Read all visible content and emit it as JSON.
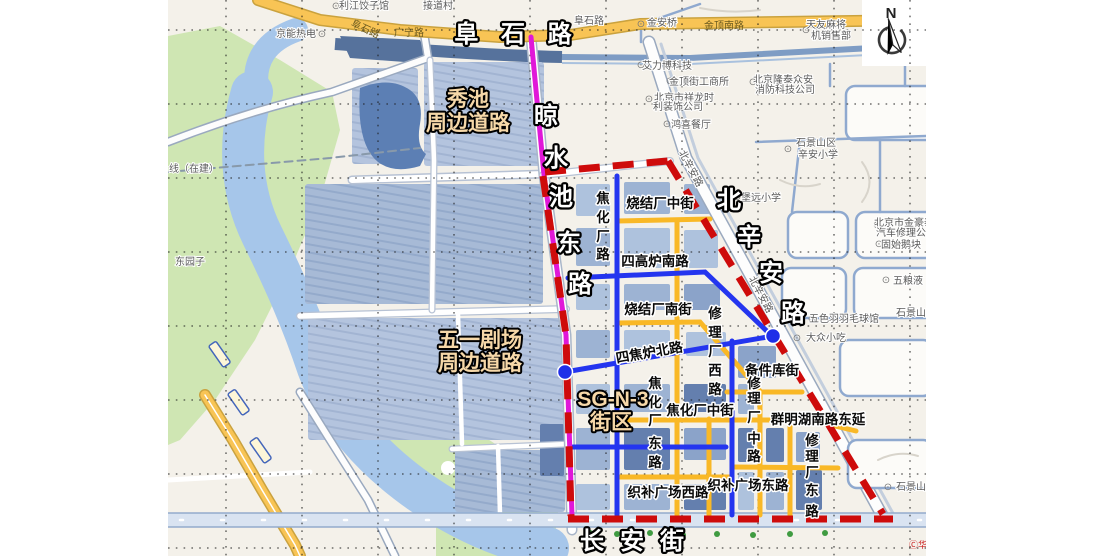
{
  "map": {
    "colors": {
      "boundary_red": "#ce0b0b",
      "highlight_magenta": "#e018d8",
      "overlay_blue_road": "#2435ef",
      "overlay_yellow_road": "#f9b826",
      "junction_dot_blue": "#1f2fe8",
      "annotation_tan": "#f6d8a8",
      "annotation_white": "#ffffff",
      "water": "#a6c6ea",
      "water_dark": "#56729c",
      "park_green": "#cfe6b3",
      "block_blue_light": "#aec2dd",
      "block_blue_dark": "#647fae"
    },
    "compass": {
      "label": "N"
    },
    "labels": [
      {
        "name": "annotation-fushi-road",
        "cls": "aw",
        "size": 25,
        "ls": 8,
        "x": 517,
        "y": 42,
        "text": "阜 石 路"
      },
      {
        "name": "annotation-liangshuichi-east-road",
        "cls": "aw",
        "size": 23,
        "chars": [
          {
            "c": "晾",
            "x": 546,
            "y": 124
          },
          {
            "c": "水",
            "x": 556,
            "y": 166
          },
          {
            "c": "池",
            "x": 561,
            "y": 205
          },
          {
            "c": "东",
            "x": 569,
            "y": 251
          },
          {
            "c": "路",
            "x": 580,
            "y": 292
          }
        ]
      },
      {
        "name": "annotation-beixinan-road",
        "cls": "aw",
        "size": 25,
        "chars": [
          {
            "c": "北",
            "x": 729,
            "y": 208
          },
          {
            "c": "辛",
            "x": 749,
            "y": 245
          },
          {
            "c": "安",
            "x": 771,
            "y": 281
          },
          {
            "c": "路",
            "x": 793,
            "y": 321
          }
        ]
      },
      {
        "name": "annotation-changan-street",
        "cls": "aw",
        "size": 26,
        "ls": 16,
        "x": 640,
        "y": 549,
        "text": "长安街"
      },
      {
        "name": "annotation-xiuchi-line1",
        "cls": "at",
        "size": 22,
        "x": 468,
        "y": 106,
        "text": "秀池"
      },
      {
        "name": "annotation-xiuchi-line2",
        "cls": "at",
        "size": 22,
        "x": 468,
        "y": 130,
        "text": "周边道路"
      },
      {
        "name": "annotation-wuyi-theater-line1",
        "cls": "at",
        "size": 21,
        "x": 480,
        "y": 347,
        "text": "五一剧场"
      },
      {
        "name": "annotation-wuyi-theater-line2",
        "cls": "at",
        "size": 21,
        "x": 480,
        "y": 370,
        "text": "周边道路"
      },
      {
        "name": "annotation-sg-n-3",
        "cls": "at",
        "size": 27,
        "x": 613,
        "y": 406,
        "text": "SG-N-3"
      },
      {
        "name": "annotation-sg-n-3-block",
        "cls": "at",
        "size": 24,
        "x": 611,
        "y": 429,
        "text": "街区"
      },
      {
        "name": "road-label-jiaohuachang-road",
        "cls": "rl",
        "layer": "lr",
        "chars": [
          {
            "c": "焦",
            "x": 603,
            "y": 203
          },
          {
            "c": "化",
            "x": 603,
            "y": 222
          },
          {
            "c": "厂",
            "x": 603,
            "y": 241
          },
          {
            "c": "路",
            "x": 603,
            "y": 259
          }
        ]
      },
      {
        "name": "road-label-shaojiechang-middle-st",
        "cls": "rl",
        "layer": "lr",
        "x": 660,
        "y": 208,
        "text": "烧结厂中街"
      },
      {
        "name": "road-label-sigaolu-south-road",
        "cls": "rl",
        "layer": "lr",
        "x": 655,
        "y": 266,
        "text": "四高炉南路"
      },
      {
        "name": "road-label-shaojiechang-south-st",
        "cls": "rl",
        "layer": "lr",
        "x": 658,
        "y": 314,
        "text": "烧结厂南街"
      },
      {
        "name": "road-label-xiulichang-west-road",
        "cls": "rl",
        "layer": "lr",
        "chars": [
          {
            "c": "修",
            "x": 715,
            "y": 318
          },
          {
            "c": "理",
            "x": 715,
            "y": 337
          },
          {
            "c": "厂",
            "x": 715,
            "y": 356
          },
          {
            "c": "西",
            "x": 715,
            "y": 375
          },
          {
            "c": "路",
            "x": 715,
            "y": 394
          }
        ]
      },
      {
        "name": "road-label-sijiaolu-north-road",
        "cls": "rl",
        "layer": "lr",
        "x": 650,
        "y": 357,
        "rot": -10,
        "text": "四焦炉北路",
        "size": 15
      },
      {
        "name": "road-label-jiaohuachang-east-road",
        "cls": "rl",
        "layer": "lr",
        "chars": [
          {
            "c": "焦",
            "x": 655,
            "y": 388
          },
          {
            "c": "化",
            "x": 655,
            "y": 407
          },
          {
            "c": "厂",
            "x": 655,
            "y": 425
          },
          {
            "c": "东",
            "x": 655,
            "y": 448
          },
          {
            "c": "路",
            "x": 655,
            "y": 467
          }
        ]
      },
      {
        "name": "road-label-jiaohuachang-middle-st",
        "cls": "rl",
        "layer": "lr",
        "x": 700,
        "y": 415,
        "text": "焦化厂中街"
      },
      {
        "name": "road-label-beijianku-st",
        "cls": "rl",
        "layer": "lr",
        "x": 772,
        "y": 375,
        "text": "备件库街"
      },
      {
        "name": "road-label-xiulichang-middle-road",
        "cls": "rl",
        "layer": "lr",
        "chars": [
          {
            "c": "修",
            "x": 754,
            "y": 388
          },
          {
            "c": "理",
            "x": 754,
            "y": 403
          },
          {
            "c": "厂",
            "x": 754,
            "y": 422
          },
          {
            "c": "中",
            "x": 754,
            "y": 443
          },
          {
            "c": "路",
            "x": 754,
            "y": 461
          }
        ]
      },
      {
        "name": "road-label-qunminghu-south-road-ext",
        "cls": "rl",
        "layer": "lr",
        "x": 818,
        "y": 424,
        "text": "群明湖南路东延"
      },
      {
        "name": "road-label-xiulichang-east-road",
        "cls": "rl",
        "layer": "lr",
        "chars": [
          {
            "c": "修",
            "x": 812,
            "y": 445
          },
          {
            "c": "理",
            "x": 812,
            "y": 461
          },
          {
            "c": "厂",
            "x": 812,
            "y": 477
          },
          {
            "c": "东",
            "x": 812,
            "y": 495
          },
          {
            "c": "路",
            "x": 812,
            "y": 516
          }
        ]
      },
      {
        "name": "road-label-zhibu-square-west-road",
        "cls": "rl",
        "layer": "lr",
        "x": 668,
        "y": 497,
        "text": "织补广场西路"
      },
      {
        "name": "road-label-zhibu-square-east-road",
        "cls": "rl",
        "layer": "lr",
        "x": 748,
        "y": 490,
        "text": "织补广场东路"
      },
      {
        "name": "poi-jiedaocun",
        "cls": "pl",
        "layer": "lb",
        "x": 438,
        "y": 9,
        "text": "接道村"
      },
      {
        "name": "poi-icon-restaurant",
        "cls": "pic",
        "layer": "lb",
        "x": 336,
        "y": 9,
        "text": "⊙"
      },
      {
        "name": "poi-lijiang-dumplings",
        "cls": "pl",
        "layer": "lb",
        "x": 364,
        "y": 9,
        "text": "利江饺子馆"
      },
      {
        "name": "poi-jingneng-thermal",
        "cls": "pl",
        "layer": "lb",
        "x": 296,
        "y": 37,
        "text": "京能热电"
      },
      {
        "name": "poi-icon-generic-1",
        "cls": "pic",
        "layer": "lb",
        "x": 322,
        "y": 37,
        "text": "⊙"
      },
      {
        "name": "road-label-fushi-small",
        "cls": "ply",
        "layer": "lb",
        "x": 364,
        "y": 32,
        "rot": 25,
        "text": "阜石路"
      },
      {
        "name": "road-label-guangning",
        "cls": "ply",
        "layer": "lb",
        "x": 409,
        "y": 36,
        "text": "广宁路"
      },
      {
        "name": "road-label-fushi-small-2",
        "cls": "pl",
        "layer": "lb",
        "x": 589,
        "y": 24,
        "text": "阜石路"
      },
      {
        "name": "poi-icon-metro",
        "cls": "pic",
        "layer": "lb",
        "x": 641,
        "y": 27,
        "text": "⊙",
        "fill": "#6a5acd"
      },
      {
        "name": "poi-jinanqiao",
        "cls": "pl",
        "layer": "lb",
        "x": 662,
        "y": 26,
        "text": "金安桥"
      },
      {
        "name": "road-label-jinding-south",
        "cls": "ply",
        "layer": "lb",
        "x": 724,
        "y": 29,
        "text": "金顶南路"
      },
      {
        "name": "poi-icon-generic-2",
        "cls": "pic",
        "layer": "lb",
        "x": 806,
        "y": 33,
        "text": "⊙",
        "fill": "#8a6ad0"
      },
      {
        "name": "poi-tianyou-majiang-line1",
        "cls": "pl",
        "layer": "lb",
        "x": 826,
        "y": 28,
        "text": "天友麻将"
      },
      {
        "name": "poi-tianyou-majiang-line2",
        "cls": "pl",
        "layer": "lb",
        "x": 831,
        "y": 39,
        "text": "机销售部"
      },
      {
        "name": "poi-icon-generic-3",
        "cls": "pic",
        "layer": "lb",
        "x": 641,
        "y": 68,
        "text": "⊙"
      },
      {
        "name": "poi-ailibo-tech",
        "cls": "pl",
        "layer": "lb",
        "x": 667,
        "y": 69,
        "text": "艾力博科技"
      },
      {
        "name": "poi-icon-generic-4",
        "cls": "pic",
        "layer": "lb",
        "x": 670,
        "y": 84,
        "text": "⊙"
      },
      {
        "name": "poi-jindingjie-gongshangsuo",
        "cls": "pl",
        "layer": "lb",
        "x": 699,
        "y": 85,
        "text": "金顶街工商所"
      },
      {
        "name": "poi-icon-generic-5",
        "cls": "pic",
        "layer": "lb",
        "x": 753,
        "y": 85,
        "text": "⊙"
      },
      {
        "name": "poi-longtai-line1",
        "cls": "pl",
        "layer": "lb",
        "x": 783,
        "y": 83,
        "text": "北京隆泰众安"
      },
      {
        "name": "poi-longtai-line2",
        "cls": "pl",
        "layer": "lb",
        "x": 785,
        "y": 93,
        "text": "消防科技公司"
      },
      {
        "name": "poi-icon-generic-6",
        "cls": "pic",
        "layer": "lb",
        "x": 649,
        "y": 102,
        "text": "⊙"
      },
      {
        "name": "poi-xianglong-line1",
        "cls": "pl",
        "layer": "lb",
        "x": 684,
        "y": 101,
        "text": "北京市祥龙时"
      },
      {
        "name": "poi-xianglong-line2",
        "cls": "pl",
        "layer": "lb",
        "x": 678,
        "y": 110,
        "text": "利装饰公司"
      },
      {
        "name": "poi-icon-food-1",
        "cls": "pic",
        "layer": "lb",
        "x": 667,
        "y": 127,
        "text": "⊙",
        "fill": "#e07b10"
      },
      {
        "name": "poi-hongxi-restaurant",
        "cls": "pl",
        "layer": "lb",
        "x": 691,
        "y": 128,
        "text": "鸿喜餐厅"
      },
      {
        "name": "poi-icon-school-1",
        "cls": "pic",
        "layer": "lb",
        "x": 788,
        "y": 152,
        "text": "⊙"
      },
      {
        "name": "poi-xinan-school-line1",
        "cls": "pl",
        "layer": "lb",
        "x": 816,
        "y": 146,
        "text": "石景山区"
      },
      {
        "name": "poi-xinan-school-line2",
        "cls": "pl",
        "layer": "lb",
        "x": 818,
        "y": 158,
        "text": "辛安小学"
      },
      {
        "name": "poi-icon-school-2",
        "cls": "pic",
        "layer": "lb",
        "x": 737,
        "y": 200,
        "text": "⊙"
      },
      {
        "name": "poi-baoyuan-school",
        "cls": "pl",
        "layer": "lb",
        "x": 761,
        "y": 201,
        "text": "堡远小学"
      },
      {
        "name": "road-label-beixinan-small-1",
        "cls": "pl",
        "layer": "lb",
        "x": 688,
        "y": 170,
        "rot": 62,
        "text": "北辛安路",
        "size": 9.5
      },
      {
        "name": "road-label-beixinan-small-2",
        "cls": "pl",
        "layer": "lb",
        "x": 758,
        "y": 296,
        "rot": 62,
        "text": "北辛安路",
        "size": 9.5
      },
      {
        "name": "poi-icon-generic-7",
        "cls": "pic",
        "layer": "lb",
        "x": 877,
        "y": 228,
        "text": "⊙"
      },
      {
        "name": "poi-jinhaotai-line1",
        "cls": "pl",
        "layer": "lb",
        "x": 904,
        "y": 226,
        "text": "北京市金豪泰"
      },
      {
        "name": "poi-jinhaotai-line2",
        "cls": "pl",
        "layer": "lb",
        "x": 906,
        "y": 236,
        "text": "汽车修理公司"
      },
      {
        "name": "poi-icon-food-2",
        "cls": "pic",
        "layer": "lb",
        "x": 879,
        "y": 247,
        "text": "⊙",
        "fill": "#e07b10"
      },
      {
        "name": "poi-gushi-ekuai",
        "cls": "pl",
        "layer": "lb",
        "x": 901,
        "y": 248,
        "text": "固始鹅块"
      },
      {
        "name": "poi-icon-generic-8",
        "cls": "pic",
        "layer": "lb",
        "x": 886,
        "y": 283,
        "text": "⊙"
      },
      {
        "name": "poi-wuliangye",
        "cls": "pl",
        "layer": "lb",
        "x": 908,
        "y": 284,
        "text": "五粮液"
      },
      {
        "name": "poi-shijingshan-1",
        "cls": "pl",
        "layer": "lb",
        "x": 911,
        "y": 316,
        "text": "石景山"
      },
      {
        "name": "poi-icon-generic-9",
        "cls": "pic",
        "layer": "lb",
        "x": 812,
        "y": 322,
        "text": "⊙"
      },
      {
        "name": "poi-wuseyu-badminton",
        "cls": "pl",
        "layer": "lb",
        "x": 844,
        "y": 322,
        "text": "五色羽羽毛球馆"
      },
      {
        "name": "poi-icon-generic-10",
        "cls": "pic",
        "layer": "lb",
        "x": 797,
        "y": 341,
        "text": "⊙"
      },
      {
        "name": "poi-dazhong-snacks",
        "cls": "pl",
        "layer": "lb",
        "x": 826,
        "y": 341,
        "text": "大众小吃"
      },
      {
        "name": "poi-icon-mountain",
        "cls": "pic",
        "layer": "lb",
        "x": 888,
        "y": 490,
        "text": "⊙",
        "fill": "#3a8a3a"
      },
      {
        "name": "poi-shijingshan-2",
        "cls": "pl",
        "layer": "lb",
        "x": 911,
        "y": 490,
        "text": "石景山"
      },
      {
        "name": "poi-dongyuanzi",
        "cls": "pl",
        "layer": "lb",
        "x": 190,
        "y": 265,
        "text": "东园子"
      },
      {
        "name": "poi-line-under-construction",
        "cls": "pl",
        "layer": "lb",
        "x": 194,
        "y": 172,
        "text": "线（在建）"
      },
      {
        "name": "copyright-mark",
        "cls": "cpr",
        "layer": "lb",
        "x": 918,
        "y": 548,
        "text": "Ⓒ华"
      }
    ]
  }
}
